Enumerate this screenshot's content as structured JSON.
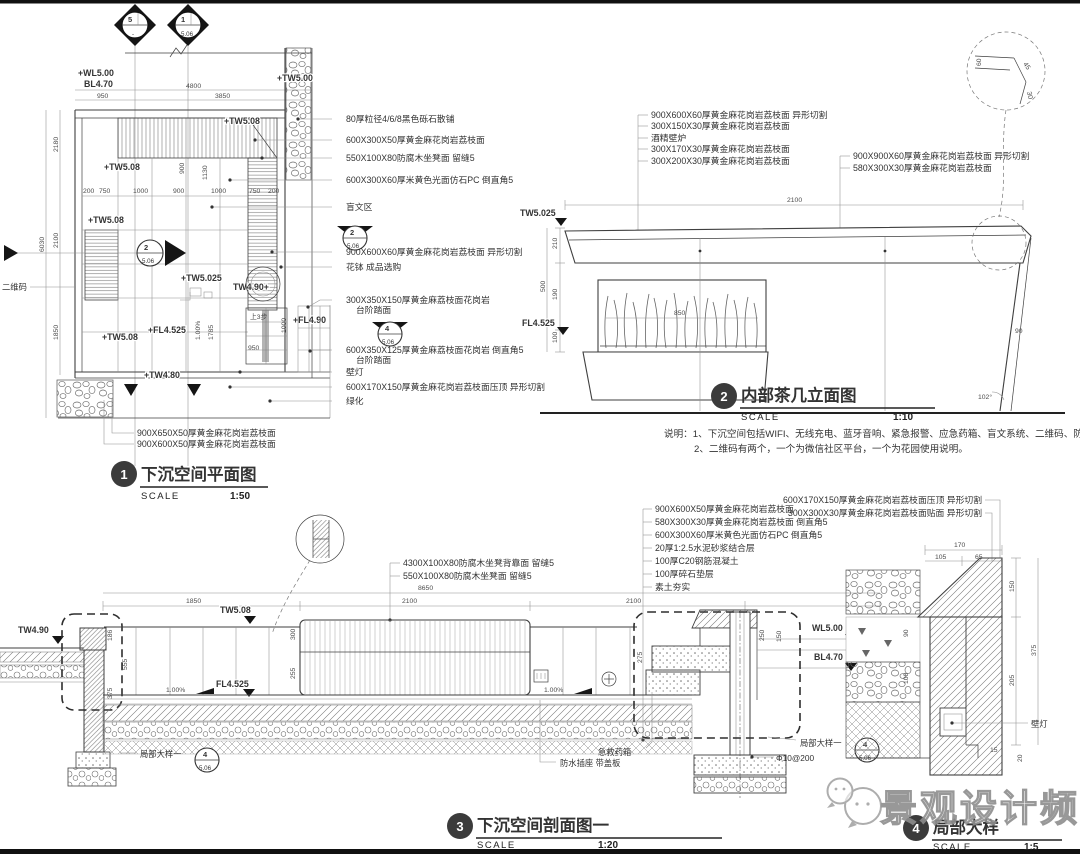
{
  "meta": {
    "paper": "#ffffff",
    "ink": "#3f3f3f",
    "faint": "#8f8f8f",
    "bar": "#111111"
  },
  "watermark": {
    "label": "景观设计频道",
    "icon": "wechat-icon"
  },
  "notes": {
    "line1": "说明：1、下沉空间包括WIFI、无线充电、蓝牙音响、紧急报警、应急药箱、盲文系统、二维码、防水插座。",
    "line2": "2、二维码有两个，一个为微信社区平台，一个为花园使用说明。"
  },
  "titles": {
    "plan": {
      "num": "1",
      "name": "下沉空间平面图",
      "scale_word": "SCALE",
      "scale": "1:50"
    },
    "elev": {
      "num": "2",
      "name": "内部茶几立面图",
      "scale_word": "SCALE",
      "scale": "1:10"
    },
    "sect": {
      "num": "3",
      "name": "下沉空间剖面图一",
      "scale_word": "SCALE",
      "scale": "1:20"
    },
    "detail": {
      "num": "4",
      "name": "局部大样",
      "scale_word": "SCALE",
      "scale": "1:5"
    }
  },
  "plan": {
    "levels": {
      "wl": "+WL5.00",
      "bl": "BL4.70",
      "tw500": "+TW5.00",
      "tw508": "+TW5.08",
      "tw5025": "+TW5.025",
      "tw490": "TW4.90+",
      "fl4525": "+FL4.525",
      "fl490": "+FL4.90",
      "tw480": "+TW4.80"
    },
    "dims": {
      "d4800": "4800",
      "d950": "950",
      "d3850": "3850",
      "d2180": "2180",
      "d6030": "6030",
      "d2100": "2100",
      "d1850": "1850",
      "d1130": "1130",
      "d900": "900",
      "d1785": "1785",
      "d950b": "950",
      "d1000": "1000",
      "row": [
        "200",
        "750",
        "1000",
        "900",
        "1000",
        "750",
        "200"
      ]
    },
    "misc": {
      "qr": "二维码",
      "slope": "1.00%",
      "steps": "上3步"
    },
    "ann": [
      "80厚粒径4/6/8黑色砾石散铺",
      "600X300X50厚黄金麻花岗岩荔枝面",
      "550X100X80防腐木坐凳面 留缝5",
      "600X300X60厚米黄色光面仿石PC 倒直角5",
      "盲文区",
      "900X600X60厚黄金麻花岗岩荔枝面 异形切割",
      "花钵 成品选购",
      "300X350X150厚黄金麻荔枝面花岗岩",
      "台阶踏面",
      "600X350X125厚黄金麻荔枝面花岗岩 倒直角5",
      "台阶踏面",
      "壁灯",
      "600X170X150厚黄金麻花岗岩荔枝面压顶 异形切割",
      "绿化"
    ],
    "ann_bottom": [
      "900X650X50厚黄金麻花岗岩荔枝面",
      "900X600X50厚黄金麻花岗岩荔枝面"
    ],
    "markers": {
      "m5": {
        "num": "5",
        "sheet": "-"
      },
      "m1": {
        "num": "1",
        "sheet": "5.06"
      },
      "m2": {
        "num": "2",
        "sheet": "5.06"
      },
      "m4": {
        "num": "4",
        "sheet": "5.06"
      }
    }
  },
  "elev": {
    "ann_left": [
      "900X600X60厚黄金麻花岗岩荔枝面 异形切割",
      "300X150X30厚黄金麻花岗岩荔枝面",
      "酒精壁炉",
      "300X170X30厚黄金麻花岗岩荔枝面",
      "300X200X30厚黄金麻花岗岩荔枝面"
    ],
    "ann_right": [
      "900X900X60厚黄金麻花岗岩荔枝面 异形切割",
      "580X300X30厚黄金麻花岗岩荔枝面"
    ],
    "levels": {
      "tw": "TW5.025",
      "fl": "FL4.525"
    },
    "dims": {
      "w": "2100",
      "h1": "210",
      "h2": "190",
      "h3": "100",
      "htot": "500",
      "plant": "850",
      "leg": "90",
      "angle": "102°"
    },
    "corner": {
      "a": "60",
      "b": "45",
      "c": "30"
    }
  },
  "sect": {
    "levels": {
      "tw490": "TW4.90",
      "tw508": "TW5.08",
      "fl": "FL4.525",
      "wl": "WL5.00",
      "bl": "BL4.70"
    },
    "slope": "1.00%",
    "dims": {
      "total": "8650",
      "a": "1850",
      "b": "2100",
      "c": "2100",
      "d186": "186",
      "d555": "555",
      "d375": "375",
      "d300": "300",
      "d255": "255",
      "d275": "275",
      "d250": "250",
      "d150": "150"
    },
    "ann_bench": [
      "4300X100X80防腐木坐凳背靠面 留缝5",
      "550X100X80防腐木坐凳面 留缝5"
    ],
    "ann_floor": [
      "900X600X50厚黄金麻花岗岩荔枝面",
      "580X300X30厚黄金麻花岗岩荔枝面 倒直角5",
      "600X300X60厚米黄色光面仿石PC 倒直角5",
      "20厚1:2.5水泥砂浆结合层",
      "100厚C20钢筋混凝土",
      "100厚碎石垫层",
      "素土夯实"
    ],
    "labels": {
      "aid": "急救药箱",
      "socket": "防水插座 带盖板",
      "detail_call": "局部大样一",
      "rebar": "Φ10@200"
    },
    "marker": {
      "num": "4",
      "sheet": "5.06"
    }
  },
  "detail": {
    "ann": [
      "600X170X150厚黄金麻花岗岩荔枝面压顶 异形切割",
      "300X300X30厚黄金麻花岗岩荔枝面贴面 异形切割"
    ],
    "lamp": "壁灯",
    "dims": {
      "d170": "170",
      "d105": "105",
      "d65": "65",
      "d150": "150",
      "d90": "90",
      "d100": "100",
      "d375": "375",
      "d205": "205",
      "d15": "15",
      "d20": "20"
    }
  }
}
